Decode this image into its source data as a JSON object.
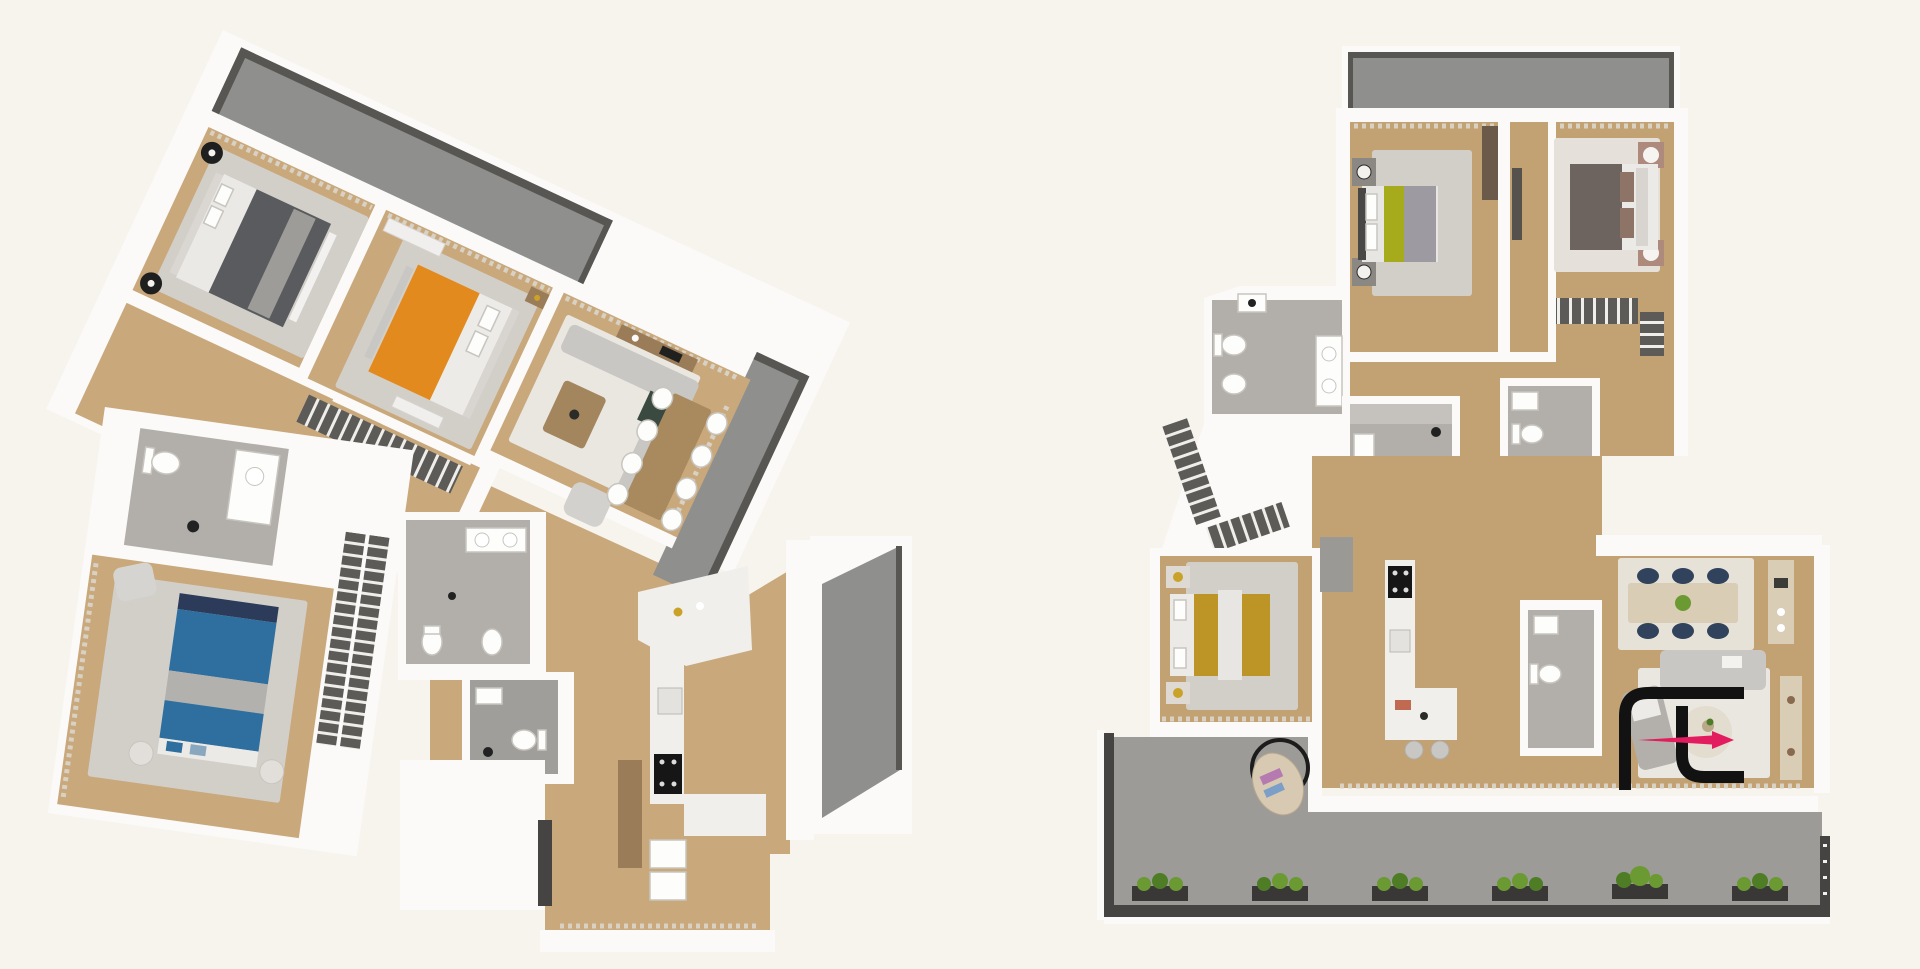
{
  "image_type": "3d-floor-plan-rendering",
  "visible_text": [],
  "watermark": {
    "name": "fl-monogram-logo",
    "elements": [
      "black-bracket-f",
      "black-bracket-l",
      "pink-arrow-right"
    ],
    "color_black": "#121212",
    "color_pink": "#e31c5f"
  },
  "colors": {
    "background": "#f7f4ee",
    "wall_white": "#fbfaf8",
    "wood_left": "#c9a87c",
    "wood_right": "#c2a173",
    "window_band": "#d8d1c4",
    "rug_gray": "#d2cfc9",
    "rug_light": "#eae7e1",
    "rug_dining": "#e7e2d8",
    "balcony_gray": "#8f8f8d",
    "balcony_rim": "#575653",
    "terrace_gray": "#9c9b97",
    "terrace_rim": "#454442",
    "bathroom_floor": "#b2afaa",
    "bathroom_floor_dark": "#a09e9a",
    "closet_dark": "#5c5b58",
    "counter_white": "#f1efec",
    "appliance_black": "#161616",
    "bed_dark": "#5a5b5f",
    "bed_orange": "#e28a1e",
    "bed_blue": "#2e6f9f",
    "bed_blue_dark": "#2c3b5a",
    "bed_green": "#a6ab1c",
    "bed_mustard": "#bd9426",
    "bed_brown": "#6e645f",
    "bed_brown_pillow": "#8d7466",
    "wood_furniture": "#9a7c58",
    "table_light": "#d9cdb6",
    "chair_navy": "#31435c",
    "sofa_gray": "#c9c7c3",
    "plant_green": "#6b9a33",
    "plant_green_dark": "#4e7d26",
    "planter_box": "#3a3836",
    "gold": "#c9a227",
    "logo_black": "#121212",
    "logo_pink": "#e31c5f"
  },
  "plans": {
    "left": {
      "rotation_deg": 25,
      "rooms": [
        "bedroom-dark-bed",
        "bedroom-orange-bed",
        "living-dining-room",
        "hallway",
        "bathroom-1",
        "bedroom-blue-bed",
        "bathroom-2",
        "bathroom-3",
        "kitchen",
        "entrance"
      ],
      "balconies": [
        "balcony-top",
        "balcony-living-side",
        "balcony-kitchen-side"
      ],
      "dining_chairs": 8,
      "beds": 3
    },
    "right": {
      "rotation_deg": 0,
      "rooms": [
        "bedroom-green-bed",
        "bedroom-brown-bed",
        "hallway",
        "bathroom-main",
        "bathroom-shower",
        "bathroom-ensuite",
        "bedroom-mustard-bed",
        "kitchen",
        "wc",
        "dining-area",
        "living-area"
      ],
      "balconies": [
        "balcony-top",
        "terrace-bottom"
      ],
      "dining_chairs": 6,
      "kitchen_stools": 2,
      "terrace_planters": 6,
      "beds": 3
    }
  }
}
